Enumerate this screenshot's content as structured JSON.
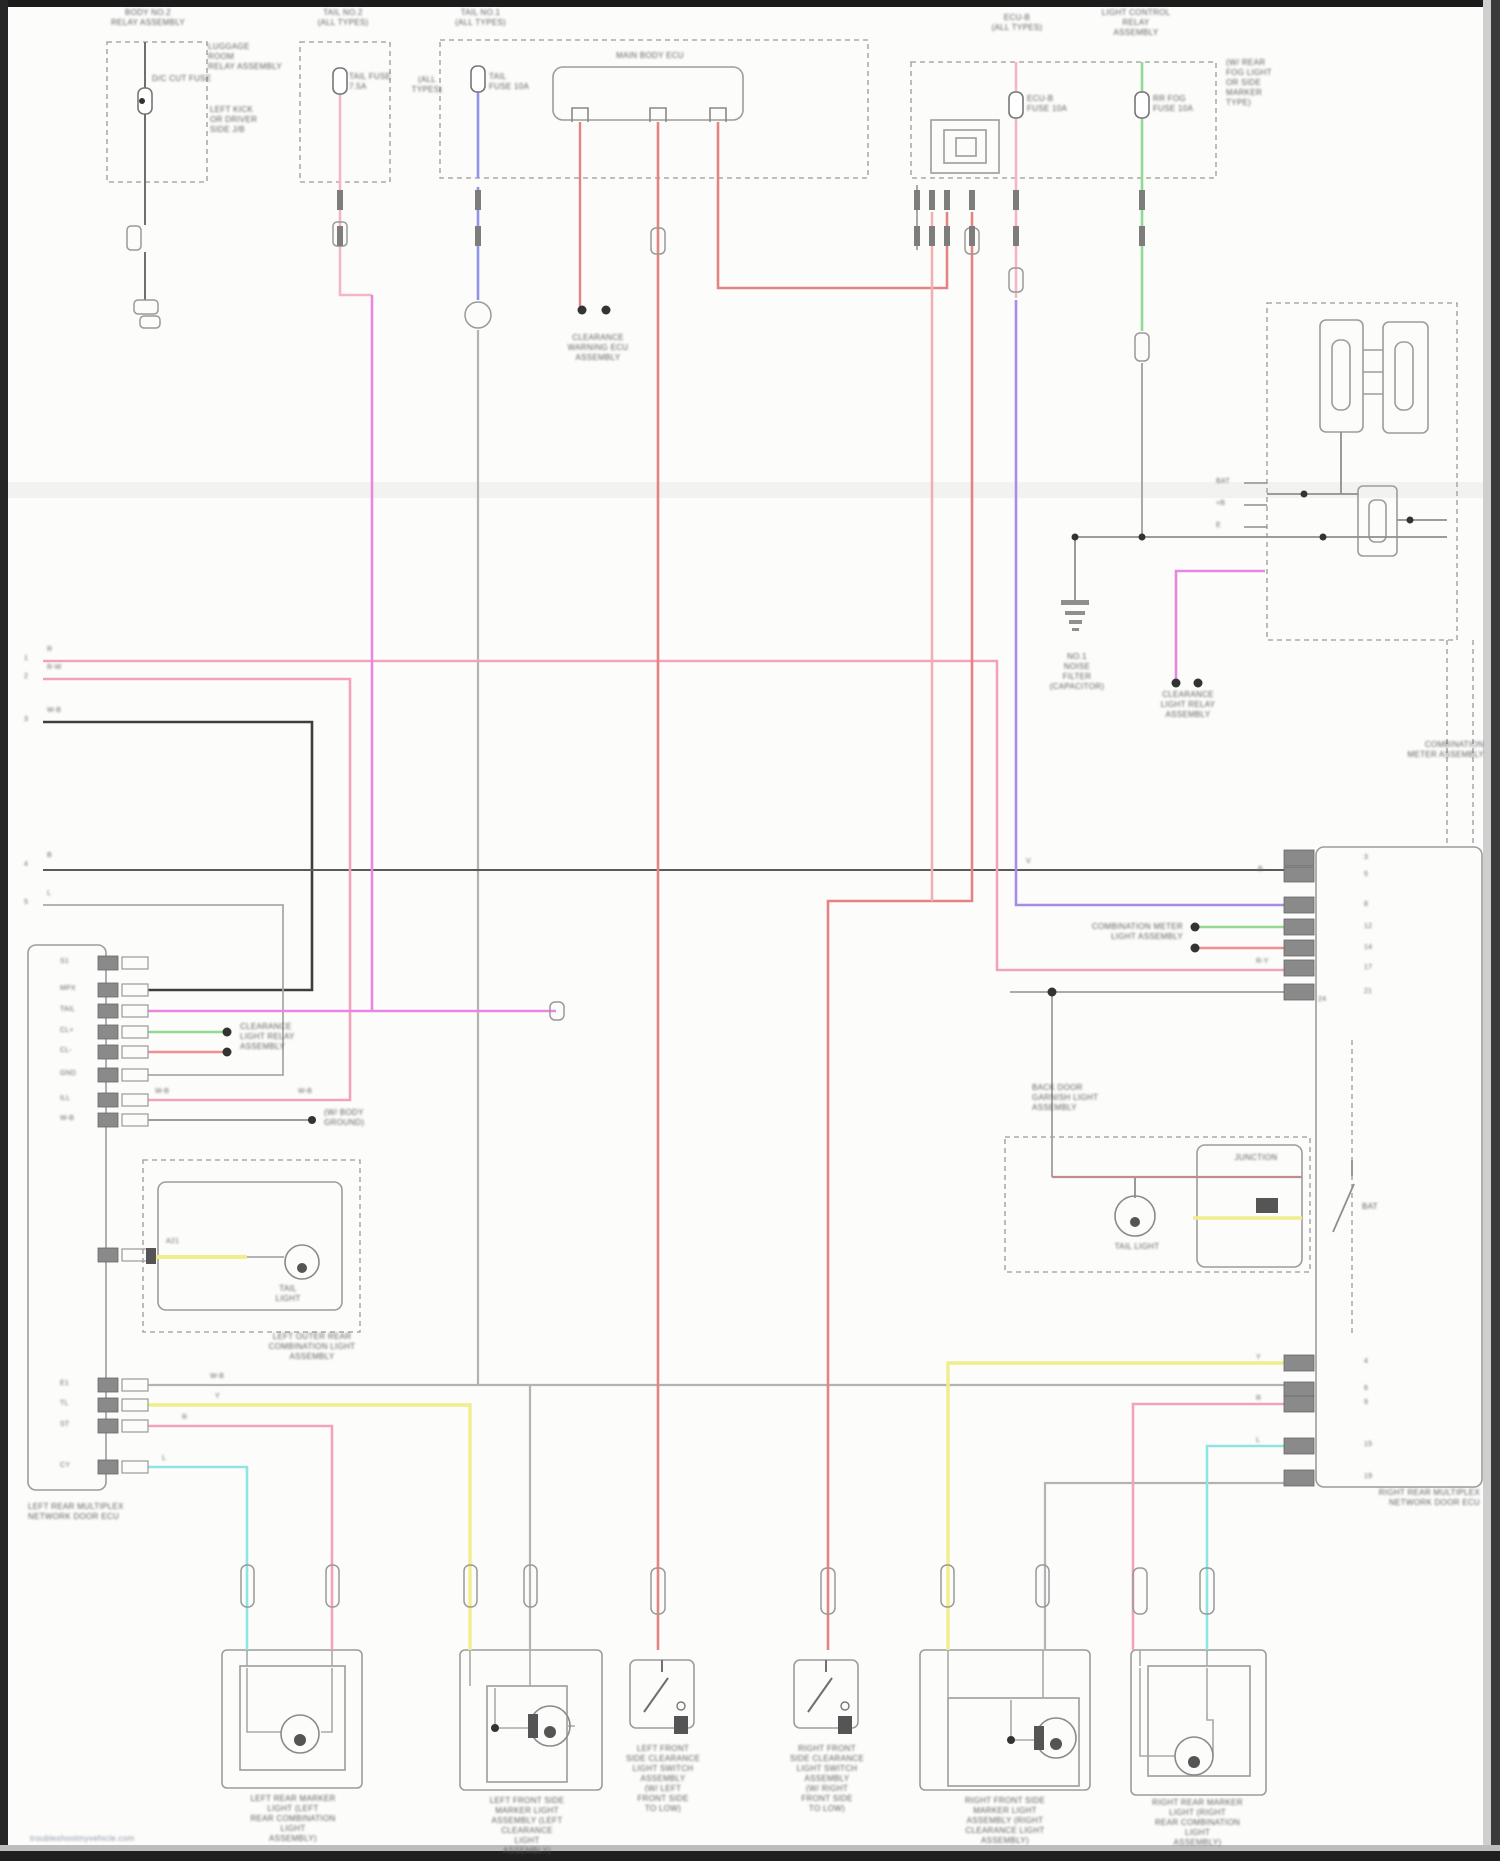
{
  "document": {
    "type": "vehicle wiring diagram (blurred scan)",
    "watermark": "troubleshootmyvehicle.com"
  },
  "palette": {
    "page_bg": "#fcfcfb",
    "frame": "#1c1c1c",
    "wire_red": "#e58383",
    "wire_red_pale": "#eeb0b0",
    "wire_pink": "#f2a3bb",
    "wire_magenta": "#e887e2",
    "wire_violet": "#a58ee8",
    "wire_blue": "#8f93ea",
    "wire_green": "#93d893",
    "wire_yellow": "#f0ed8d",
    "wire_cyan": "#8fe3e3",
    "wire_maroon": "#bf8d8d",
    "wire_gray": "#b3b3b3",
    "wire_dark": "#4a4a4a",
    "box_line": "#9a9a9a"
  },
  "captions": [
    {
      "n": "cap-top-left-relay-block",
      "x": 83,
      "y": 8,
      "w": 130,
      "lines": [
        "BODY NO.2",
        "RELAY ASSEMBLY"
      ]
    },
    {
      "n": "cap-luggage-room",
      "x": 208,
      "y": 42,
      "w": 90,
      "a": "left",
      "lines": [
        "LUGGAGE",
        "ROOM",
        "RELAY ASSEMBLY"
      ]
    },
    {
      "n": "cap-left-kick-panel",
      "x": 210,
      "y": 105,
      "w": 90,
      "a": "left",
      "lines": [
        "LEFT KICK",
        "OR DRIVER",
        "SIDE J/B"
      ]
    },
    {
      "n": "lbl-fuse1",
      "x": 152,
      "y": 74,
      "w": 70,
      "a": "left",
      "lines": [
        "D/C CUT FUSE"
      ]
    },
    {
      "n": "cap-fuse2",
      "x": 288,
      "y": 8,
      "w": 110,
      "lines": [
        "TAIL NO.2",
        "(ALL TYPES)"
      ]
    },
    {
      "n": "lbl-fuse2",
      "x": 349,
      "y": 72,
      "w": 60,
      "a": "left",
      "lines": [
        "TAIL FUSE",
        "7.5A"
      ]
    },
    {
      "n": "cap-fuse3",
      "x": 438,
      "y": 8,
      "w": 85,
      "lines": [
        "TAIL NO.1",
        "(ALL TYPES)"
      ]
    },
    {
      "n": "lbl-fuse3-left",
      "x": 405,
      "y": 75,
      "w": 44,
      "lines": [
        "(ALL",
        "TYPES)"
      ]
    },
    {
      "n": "lbl-fuse3",
      "x": 489,
      "y": 72,
      "w": 60,
      "a": "left",
      "lines": [
        "TAIL",
        "FUSE 10A"
      ]
    },
    {
      "n": "cap-main-body-ecu",
      "x": 575,
      "y": 51,
      "w": 150,
      "lines": [
        "MAIN BODY ECU"
      ]
    },
    {
      "n": "cap-fuse4",
      "x": 973,
      "y": 13,
      "w": 88,
      "lines": [
        "ECU-B",
        "(ALL TYPES)"
      ]
    },
    {
      "n": "cap-light-control-relay",
      "x": 1072,
      "y": 8,
      "w": 128,
      "lines": [
        "LIGHT CONTROL",
        "RELAY",
        "ASSEMBLY"
      ]
    },
    {
      "n": "lbl-fuse4",
      "x": 1027,
      "y": 94,
      "w": 60,
      "a": "left",
      "lines": [
        "ECU-B",
        "FUSE 10A"
      ]
    },
    {
      "n": "lbl-fuse5",
      "x": 1153,
      "y": 94,
      "w": 62,
      "a": "left",
      "lines": [
        "RR FOG",
        "FUSE 10A"
      ]
    },
    {
      "n": "cap-rear-fog-note",
      "x": 1226,
      "y": 58,
      "w": 80,
      "a": "left",
      "lines": [
        "(W/ REAR",
        "FOG LIGHT",
        "OR SIDE",
        "MARKER",
        "TYPE)"
      ]
    },
    {
      "n": "cap-clearance-warning-ecu",
      "x": 548,
      "y": 333,
      "w": 100,
      "lines": [
        "CLEARANCE",
        "WARNING ECU",
        "ASSEMBLY"
      ]
    },
    {
      "n": "cap-noise-filter",
      "x": 1034,
      "y": 652,
      "w": 86,
      "lines": [
        "NO.1",
        "NOISE",
        "FILTER",
        "(CAPACITOR)"
      ]
    },
    {
      "n": "cap-clearance-light-relay",
      "x": 1138,
      "y": 690,
      "w": 100,
      "lines": [
        "CLEARANCE",
        "LIGHT RELAY",
        "ASSEMBLY"
      ]
    },
    {
      "n": "cap-combination-meter",
      "x": 1352,
      "y": 740,
      "w": 132,
      "a": "right",
      "lines": [
        "COMBINATION",
        "METER ASSEMBLY"
      ]
    },
    {
      "n": "cap-meter-light",
      "x": 1068,
      "y": 922,
      "w": 115,
      "a": "right",
      "lines": [
        "COMBINATION METER",
        "LIGHT ASSEMBLY"
      ]
    },
    {
      "n": "cap-body-ground-note",
      "x": 324,
      "y": 1108,
      "w": 80,
      "a": "left",
      "lines": [
        "(W/ BODY",
        "GROUND)"
      ]
    },
    {
      "n": "cap-clearance-relay-left",
      "x": 240,
      "y": 1022,
      "w": 96,
      "a": "left",
      "lines": [
        "CLEARANCE",
        "LIGHT RELAY",
        "ASSEMBLY"
      ]
    },
    {
      "n": "cap-left-tail-light",
      "x": 248,
      "y": 1284,
      "w": 80,
      "lines": [
        "TAIL",
        "LIGHT"
      ]
    },
    {
      "n": "cap-left-outer-rear-comb",
      "x": 238,
      "y": 1332,
      "w": 148,
      "lines": [
        "LEFT OUTER REAR",
        "COMBINATION LIGHT",
        "ASSEMBLY"
      ]
    },
    {
      "n": "cap-back-door-garnish",
      "x": 1032,
      "y": 1083,
      "w": 118,
      "a": "left",
      "lines": [
        "BACK DOOR",
        "GARNISH LIGHT",
        "ASSEMBLY"
      ]
    },
    {
      "n": "cap-bd-tail-light",
      "x": 1094,
      "y": 1242,
      "w": 86,
      "lines": [
        "TAIL LIGHT"
      ]
    },
    {
      "n": "lbl-bd-junction",
      "x": 1220,
      "y": 1153,
      "w": 72,
      "lines": [
        "JUNCTION"
      ]
    },
    {
      "n": "lbl-bat",
      "x": 1362,
      "y": 1202,
      "w": 40,
      "a": "left",
      "lines": [
        "BAT"
      ]
    },
    {
      "n": "cap-left-rear-ecu",
      "x": 28,
      "y": 1502,
      "w": 320,
      "a": "left",
      "lines": [
        "LEFT REAR MULTIPLEX",
        "NETWORK DOOR ECU"
      ]
    },
    {
      "n": "cap-right-rear-ecu",
      "x": 1175,
      "y": 1488,
      "w": 305,
      "a": "right",
      "lines": [
        "RIGHT REAR MULTIPLEX",
        "NETWORK DOOR ECU"
      ]
    },
    {
      "n": "cap-box1",
      "x": 223,
      "y": 1794,
      "w": 140,
      "lines": [
        "LEFT REAR MARKER",
        "LIGHT (LEFT",
        "REAR COMBINATION",
        "LIGHT",
        "ASSEMBLY)"
      ]
    },
    {
      "n": "cap-box2",
      "x": 448,
      "y": 1796,
      "w": 158,
      "lines": [
        "LEFT FRONT SIDE",
        "MARKER LIGHT",
        "ASSEMBLY (LEFT",
        "CLEARANCE",
        "LIGHT",
        "ASSEMBLY)"
      ]
    },
    {
      "n": "cap-box3",
      "x": 604,
      "y": 1744,
      "w": 118,
      "lines": [
        "LEFT FRONT",
        "SIDE CLEARANCE",
        "LIGHT SWITCH",
        "ASSEMBLY",
        "(W/ LEFT",
        "FRONT SIDE",
        "TO LOW)"
      ]
    },
    {
      "n": "cap-box4",
      "x": 768,
      "y": 1744,
      "w": 118,
      "lines": [
        "RIGHT FRONT",
        "SIDE CLEARANCE",
        "LIGHT SWITCH",
        "ASSEMBLY",
        "(W/ RIGHT",
        "FRONT SIDE",
        "TO LOW)"
      ]
    },
    {
      "n": "cap-box5",
      "x": 920,
      "y": 1796,
      "w": 170,
      "lines": [
        "RIGHT FRONT SIDE",
        "MARKER LIGHT",
        "ASSEMBLY (RIGHT",
        "CLEARANCE LIGHT",
        "ASSEMBLY)"
      ]
    },
    {
      "n": "cap-box6",
      "x": 1120,
      "y": 1798,
      "w": 155,
      "lines": [
        "RIGHT REAR MARKER",
        "LIGHT (RIGHT",
        "REAR COMBINATION",
        "LIGHT",
        "ASSEMBLY)"
      ]
    }
  ],
  "labels": [
    {
      "n": "pin-num-1",
      "x": 24,
      "y": 655,
      "t": "1"
    },
    {
      "n": "pin-num-2",
      "x": 24,
      "y": 673,
      "t": "2"
    },
    {
      "n": "pin-num-3",
      "x": 24,
      "y": 716,
      "t": "3"
    },
    {
      "n": "pin-num-4",
      "x": 24,
      "y": 861,
      "t": "4"
    },
    {
      "n": "pin-num-5",
      "x": 24,
      "y": 899,
      "t": "5"
    },
    {
      "n": "pin-code-1",
      "x": 47,
      "y": 646,
      "t": "R"
    },
    {
      "n": "pin-code-2",
      "x": 47,
      "y": 664,
      "t": "R-W"
    },
    {
      "n": "pin-code-3",
      "x": 47,
      "y": 707,
      "t": "W-B"
    },
    {
      "n": "pin-code-4",
      "x": 47,
      "y": 852,
      "t": "B"
    },
    {
      "n": "pin-code-5",
      "x": 47,
      "y": 890,
      "t": "L"
    },
    {
      "n": "ecu-row-1",
      "x": 60,
      "y": 958,
      "t": "S1"
    },
    {
      "n": "ecu-row-2",
      "x": 60,
      "y": 985,
      "t": "MPX"
    },
    {
      "n": "ecu-row-3",
      "x": 60,
      "y": 1006,
      "t": "TAIL"
    },
    {
      "n": "ecu-row-4",
      "x": 60,
      "y": 1027,
      "t": "CL+"
    },
    {
      "n": "ecu-row-5",
      "x": 60,
      "y": 1047,
      "t": "CL-"
    },
    {
      "n": "ecu-row-6",
      "x": 60,
      "y": 1070,
      "t": "GND"
    },
    {
      "n": "ecu-row-7",
      "x": 60,
      "y": 1095,
      "t": "ILL"
    },
    {
      "n": "ecu-row-8",
      "x": 60,
      "y": 1115,
      "t": "W-B"
    },
    {
      "n": "ecu-row-9",
      "x": 166,
      "y": 1238,
      "t": "A21"
    },
    {
      "n": "ecu-row-10",
      "x": 60,
      "y": 1380,
      "t": "E1"
    },
    {
      "n": "ecu-row-11",
      "x": 60,
      "y": 1400,
      "t": "TL"
    },
    {
      "n": "ecu-row-12",
      "x": 60,
      "y": 1421,
      "t": "ST"
    },
    {
      "n": "ecu-row-13",
      "x": 60,
      "y": 1462,
      "t": "CY"
    },
    {
      "n": "meter-pin-bat",
      "x": 1216,
      "y": 478,
      "t": "BAT"
    },
    {
      "n": "meter-pin-b",
      "x": 1216,
      "y": 500,
      "t": "+B"
    },
    {
      "n": "meter-pin-e",
      "x": 1216,
      "y": 522,
      "t": "E"
    },
    {
      "n": "rb-up-1",
      "x": 1364,
      "y": 854,
      "t": "3"
    },
    {
      "n": "rb-up-2",
      "x": 1364,
      "y": 871,
      "t": "5"
    },
    {
      "n": "rb-up-3",
      "x": 1364,
      "y": 901,
      "t": "8"
    },
    {
      "n": "rb-up-4",
      "x": 1364,
      "y": 923,
      "t": "12"
    },
    {
      "n": "rb-up-5",
      "x": 1364,
      "y": 944,
      "t": "14"
    },
    {
      "n": "rb-up-6",
      "x": 1364,
      "y": 964,
      "t": "17"
    },
    {
      "n": "rb-up-7",
      "x": 1364,
      "y": 988,
      "t": "21"
    },
    {
      "n": "rb-up-code-b",
      "x": 1258,
      "y": 866,
      "t": "B"
    },
    {
      "n": "rb-up-code-ry",
      "x": 1256,
      "y": 958,
      "t": "R-Y"
    },
    {
      "n": "rb-up-24",
      "x": 1318,
      "y": 996,
      "t": "24"
    },
    {
      "n": "rb-lo-1",
      "x": 1364,
      "y": 1358,
      "t": "4"
    },
    {
      "n": "rb-lo-2",
      "x": 1364,
      "y": 1385,
      "t": "6"
    },
    {
      "n": "rb-lo-3",
      "x": 1364,
      "y": 1399,
      "t": "9"
    },
    {
      "n": "rb-lo-4",
      "x": 1364,
      "y": 1441,
      "t": "15"
    },
    {
      "n": "rb-lo-5",
      "x": 1364,
      "y": 1473,
      "t": "19"
    },
    {
      "n": "rb-lo-code-y",
      "x": 1256,
      "y": 1354,
      "t": "Y"
    },
    {
      "n": "rb-lo-code-r",
      "x": 1256,
      "y": 1395,
      "t": "R"
    },
    {
      "n": "rb-lo-code-l",
      "x": 1256,
      "y": 1437,
      "t": "L"
    },
    {
      "n": "wire-code-wb-1",
      "x": 155,
      "y": 1088,
      "t": "W-B"
    },
    {
      "n": "wire-code-wb-2",
      "x": 298,
      "y": 1088,
      "t": "W-B"
    },
    {
      "n": "wire-code-wb-3",
      "x": 210,
      "y": 1373,
      "t": "W-B"
    },
    {
      "n": "wire-code-y",
      "x": 215,
      "y": 1393,
      "t": "Y"
    },
    {
      "n": "wire-code-r",
      "x": 182,
      "y": 1414,
      "t": "R"
    },
    {
      "n": "wire-code-l",
      "x": 162,
      "y": 1455,
      "t": "L"
    },
    {
      "n": "wire-code-v",
      "x": 1026,
      "y": 858,
      "t": "V"
    }
  ]
}
